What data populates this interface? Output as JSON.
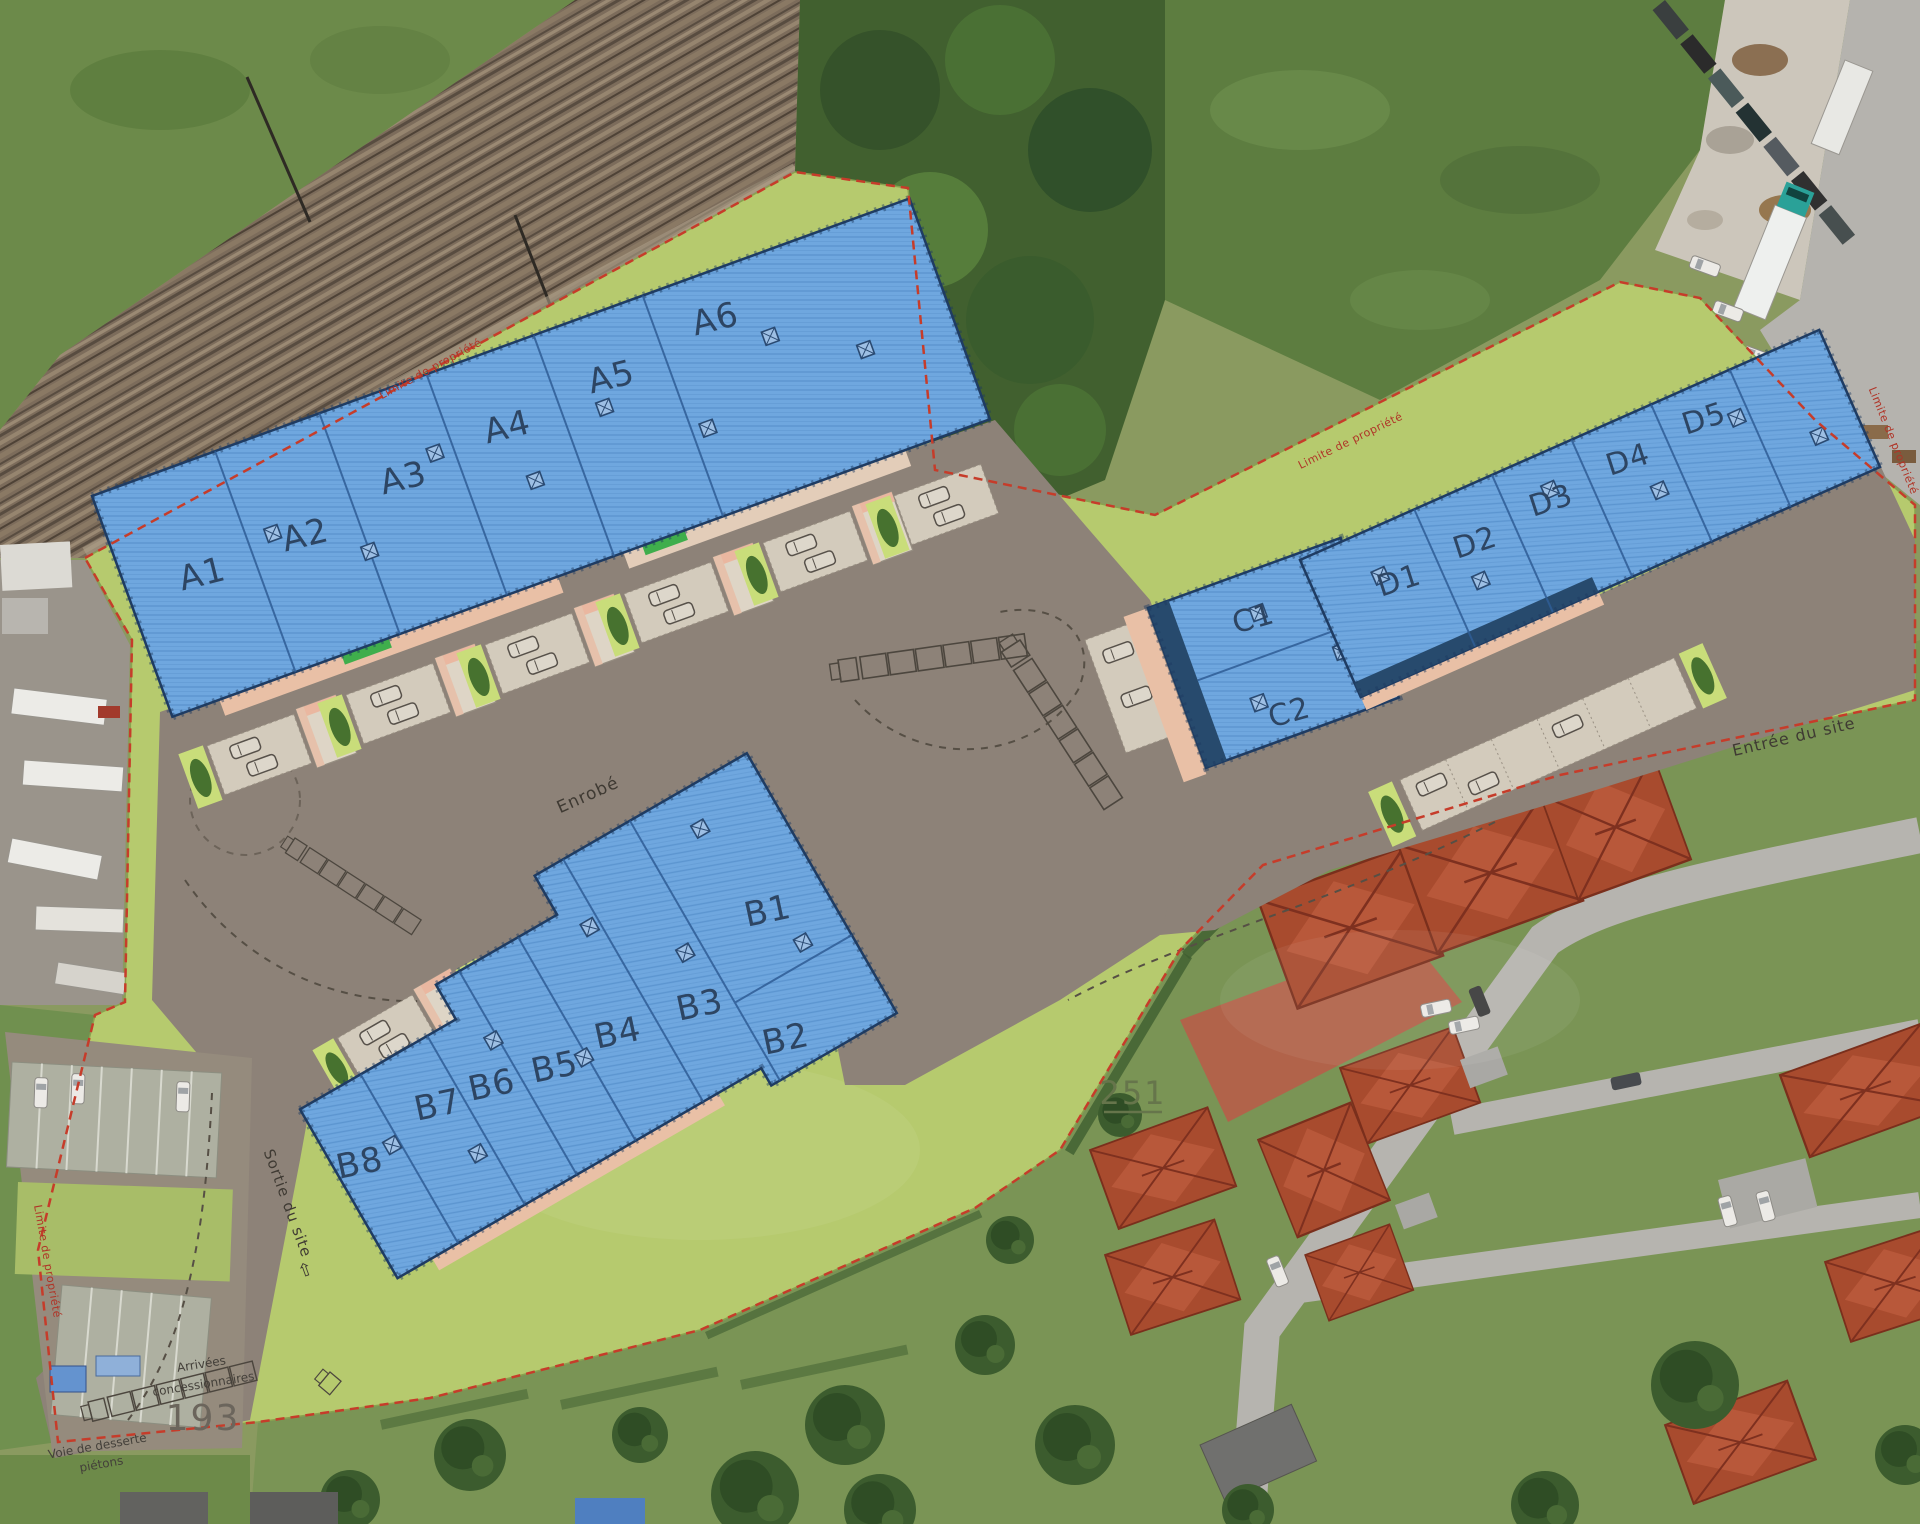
{
  "map": {
    "type": "aerial-site-plan",
    "labels": {
      "surface": "Enrobé",
      "exit": "Sortie du site",
      "exit_arrow": "⇦",
      "entrance": "Entrée du site",
      "arrivals_line1": "Arrivées",
      "arrivals_line2": "concessionnaires",
      "service_road_line1": "Voie de desserte",
      "service_road_line2": "piétons",
      "boundary": "Limite de propriété",
      "parcel_193": "193",
      "parcel_251": "251"
    },
    "buildings": [
      {
        "id": "A",
        "units": [
          "A1",
          "A2",
          "A3",
          "A4",
          "A5",
          "A6"
        ]
      },
      {
        "id": "B",
        "units": [
          "B1",
          "B2",
          "B3",
          "B4",
          "B5",
          "B6",
          "B7",
          "B8"
        ]
      },
      {
        "id": "C",
        "units": [
          "C1",
          "C2"
        ]
      },
      {
        "id": "D",
        "units": [
          "D1",
          "D2",
          "D3",
          "D4",
          "D5"
        ]
      }
    ],
    "colors": {
      "building_roof": "#6fa7df",
      "building_edge": "#1f3c63",
      "site_green": "#b6ca6e",
      "asphalt": "#8d8278",
      "boundary_red": "#c63c2a",
      "house_roof": "#a84b2e",
      "woodland": "#41602f"
    }
  }
}
